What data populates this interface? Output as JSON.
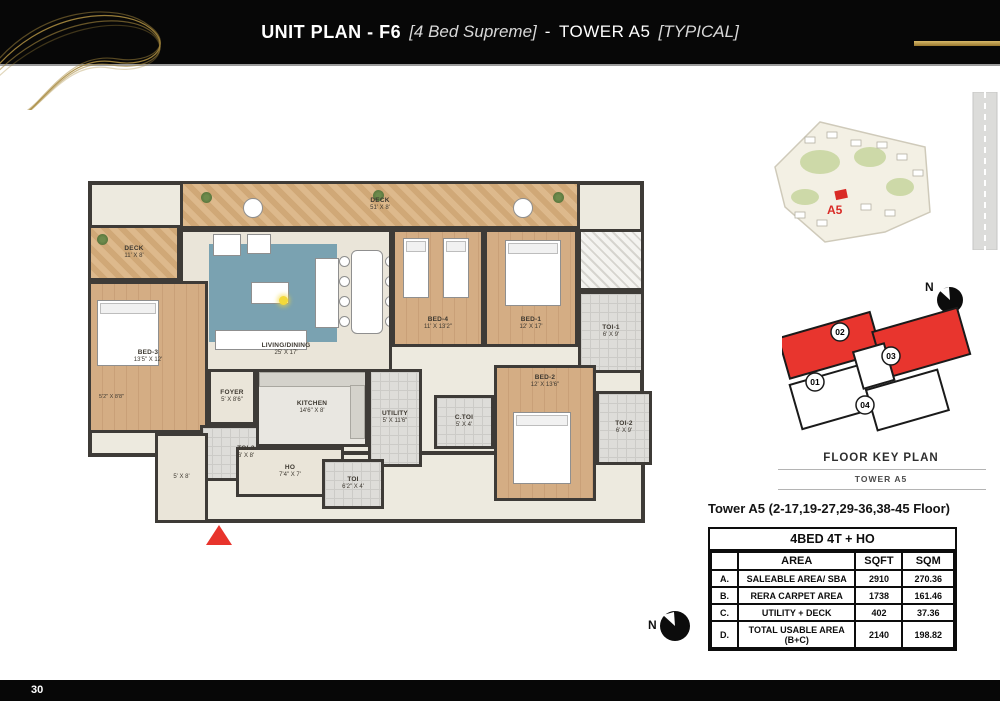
{
  "header": {
    "title_bold": "UNIT PLAN - F6",
    "title_italic1": "[4 Bed Supreme]",
    "title_dash": "-",
    "title_regular": "TOWER A5",
    "title_italic2": "[TYPICAL]",
    "gold_color": "#b8913d"
  },
  "footer": {
    "page_number": "30"
  },
  "floorplan": {
    "entrance_marker_color": "#e8342c",
    "rooms": {
      "deck_top": {
        "name": "DECK",
        "dims": "51' X 8'"
      },
      "deck_left": {
        "name": "DECK",
        "dims": "11' X 8'"
      },
      "living": {
        "name": "LIVING/DINING",
        "dims": "25' X 17'"
      },
      "bed1": {
        "name": "BED-1",
        "dims": "12' X 17'"
      },
      "bed2": {
        "name": "BED-2",
        "dims": "12' X 13'6\""
      },
      "bed3": {
        "name": "BED-3",
        "dims": "13'5\" X 12'"
      },
      "bed4": {
        "name": "BED-4",
        "dims": "11' X 13'2\""
      },
      "toi1": {
        "name": "TOI-1",
        "dims": "6' X 9'"
      },
      "toi2": {
        "name": "TOI-2",
        "dims": "6' X 9'"
      },
      "toi3": {
        "name": "TOI-3",
        "dims": "6' X 8'"
      },
      "ctoi": {
        "name": "C.TOI",
        "dims": "5' X 4'"
      },
      "toi_small": {
        "name": "TOI",
        "dims": "6'2\" X 4'"
      },
      "kitchen": {
        "name": "KITCHEN",
        "dims": "14'6\" X 8'"
      },
      "utility": {
        "name": "UTILITY",
        "dims": "5' X 11'6\""
      },
      "foyer": {
        "name": "FOYER",
        "dims": "5' X 8'6\""
      },
      "ho": {
        "name": "HO",
        "dims": "7'4\" X 7'"
      },
      "passage": {
        "dims": "5' X 8'"
      },
      "dresser": {
        "dims": "5'2\" X 8'8\""
      }
    }
  },
  "sitemap": {
    "marker_label": "A5",
    "marker_color": "#d92b26"
  },
  "compass_top": {
    "label": "N"
  },
  "compass_bottom": {
    "label": "N"
  },
  "keyplan": {
    "title": "FLOOR KEY PLAN",
    "subtitle": "TOWER A5",
    "highlight_color": "#e8352e",
    "units": [
      {
        "number": "01",
        "highlighted": false
      },
      {
        "number": "02",
        "highlighted": true
      },
      {
        "number": "03",
        "highlighted": true
      },
      {
        "number": "04",
        "highlighted": false
      }
    ]
  },
  "table": {
    "caption": "Tower A5 (2-17,19-27,29-36,38-45 Floor)",
    "header": "4BED 4T + HO",
    "columns": [
      "",
      "AREA",
      "SQFT",
      "SQM"
    ],
    "rows": [
      {
        "id": "A.",
        "area": "SALEABLE AREA/ SBA",
        "sqft": "2910",
        "sqm": "270.36"
      },
      {
        "id": "B.",
        "area": "RERA CARPET AREA",
        "sqft": "1738",
        "sqm": "161.46"
      },
      {
        "id": "C.",
        "area": "UTILITY + DECK",
        "sqft": "402",
        "sqm": "37.36"
      },
      {
        "id": "D.",
        "area": "TOTAL USABLE AREA (B+C)",
        "sqft": "2140",
        "sqm": "198.82"
      }
    ]
  }
}
